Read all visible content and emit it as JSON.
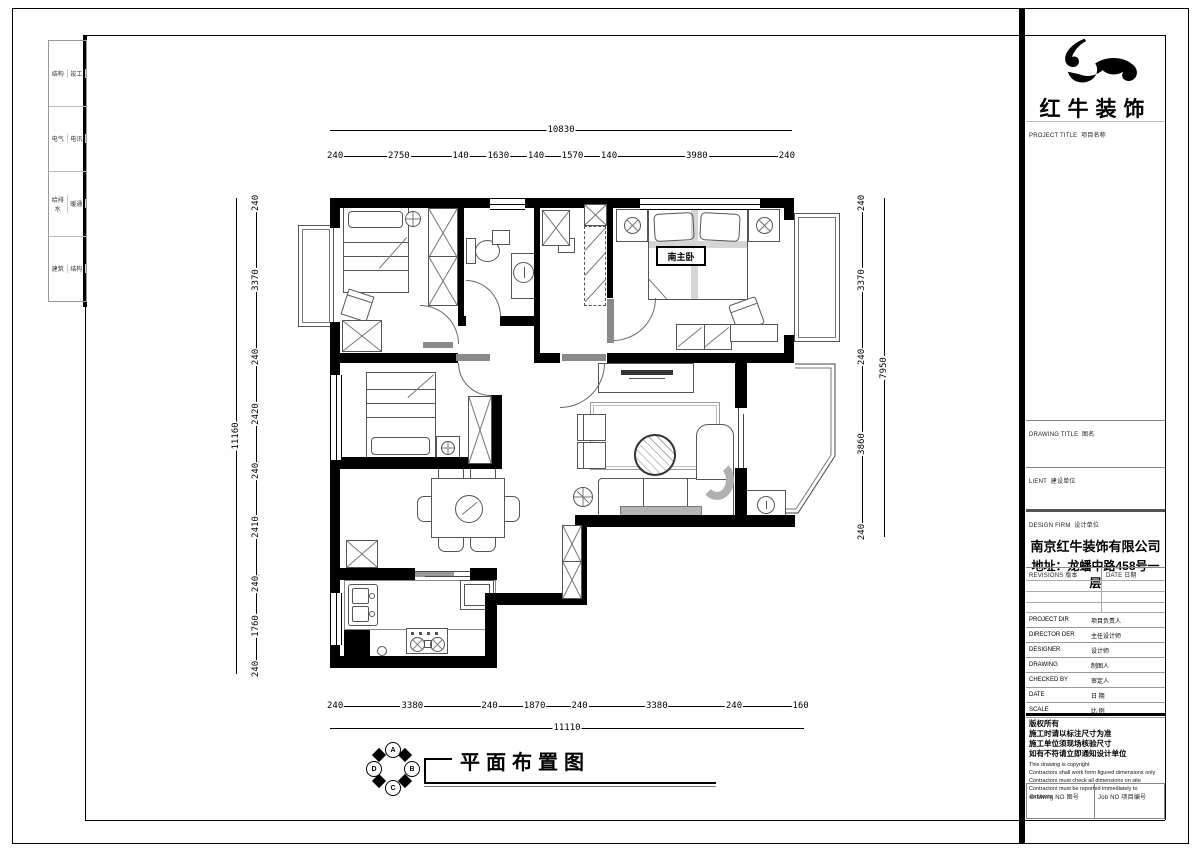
{
  "sheet": {
    "drawing_title": "平面布置图",
    "master_bedroom_label": "南主卧",
    "compass": {
      "letters": [
        "A",
        "B",
        "C",
        "D"
      ]
    },
    "disciplines": [
      [
        "结构",
        "竣工"
      ],
      [
        "电气",
        "电讯"
      ],
      [
        "给排水",
        "暖通"
      ],
      [
        "建筑",
        "结构"
      ]
    ]
  },
  "dims": {
    "top": {
      "total": "10830",
      "segments": [
        {
          "mm": 240,
          "label": "240"
        },
        {
          "mm": 2750,
          "label": "2750"
        },
        {
          "mm": 140,
          "label": "140"
        },
        {
          "mm": 1630,
          "label": "1630"
        },
        {
          "mm": 140,
          "label": "140"
        },
        {
          "mm": 1570,
          "label": "1570"
        },
        {
          "mm": 140,
          "label": "140"
        },
        {
          "mm": 3980,
          "label": "3980"
        },
        {
          "mm": 240,
          "label": "240"
        }
      ]
    },
    "left": {
      "total": "11160",
      "segments": [
        {
          "mm": 240,
          "label": "240"
        },
        {
          "mm": 3370,
          "label": "3370"
        },
        {
          "mm": 240,
          "label": "240"
        },
        {
          "mm": 2420,
          "label": "2420"
        },
        {
          "mm": 240,
          "label": "240"
        },
        {
          "mm": 2410,
          "label": "2410"
        },
        {
          "mm": 240,
          "label": "240"
        },
        {
          "mm": 1760,
          "label": "1760"
        },
        {
          "mm": 240,
          "label": "240"
        }
      ]
    },
    "right": {
      "total": "7950",
      "segments": [
        {
          "mm": 240,
          "label": "240"
        },
        {
          "mm": 3370,
          "label": "3370"
        },
        {
          "mm": 240,
          "label": "240"
        },
        {
          "mm": 3860,
          "label": "3860"
        },
        {
          "mm": 240,
          "label": "240"
        }
      ]
    },
    "bottom": {
      "total": "11110",
      "segments": [
        {
          "mm": 240,
          "label": "240"
        },
        {
          "mm": 3380,
          "label": "3380"
        },
        {
          "mm": 240,
          "label": "240"
        },
        {
          "mm": 1870,
          "label": "1870"
        },
        {
          "mm": 240,
          "label": "240"
        },
        {
          "mm": 3380,
          "label": "3380"
        },
        {
          "mm": 240,
          "label": "240"
        },
        {
          "mm": 1360,
          "label": ""
        },
        {
          "mm": 160,
          "label": "160"
        }
      ]
    }
  },
  "title_block": {
    "brand": "红牛装饰",
    "project_title_en": "PROJECT TITLE",
    "project_title_cn": "项目名称",
    "drawing_title_en": "DRAWING TITLE",
    "drawing_title_cn": "图名",
    "client_en": "LIENT",
    "client_cn": "建设单位",
    "design_firm_en": "DESIGN FIRM",
    "design_firm_cn": "设计单位",
    "firm_name": "南京红牛装饰有限公司",
    "firm_address": "地址：龙蟠中路458号一层",
    "revisions_en": "REVISIONS",
    "revisions_cn": "版本",
    "date_col_en": "DATE",
    "date_col_cn": "日期",
    "person_rows": [
      {
        "en": "PROJECT DIR",
        "cn": "项目负责人"
      },
      {
        "en": "DIRECTOR DER",
        "cn": "主任设计师"
      },
      {
        "en": "DESIGNER",
        "cn": "设计师"
      },
      {
        "en": "DRAWING",
        "cn": "制图人"
      },
      {
        "en": "CHECKED BY",
        "cn": "审定人"
      },
      {
        "en": "DATE",
        "cn": "日  期"
      },
      {
        "en": "SCALE",
        "cn": "比  例"
      }
    ],
    "copyright_cn": [
      "版权所有",
      "施工时请以标注尺寸为准",
      "施工单位须现场核验尺寸",
      "如有不符请立即通知设计单位"
    ],
    "copyright_en": [
      "This drawing is copyright",
      "Contractors shall work form figured dimensions only",
      "Contractors must check all dimensions on site",
      "Contractors must be reported immediately to architects"
    ],
    "drawing_no_en": "Drawing NO",
    "drawing_no_cn": "图号",
    "job_no_en": "Job NO",
    "job_no_cn": "项目编号"
  }
}
